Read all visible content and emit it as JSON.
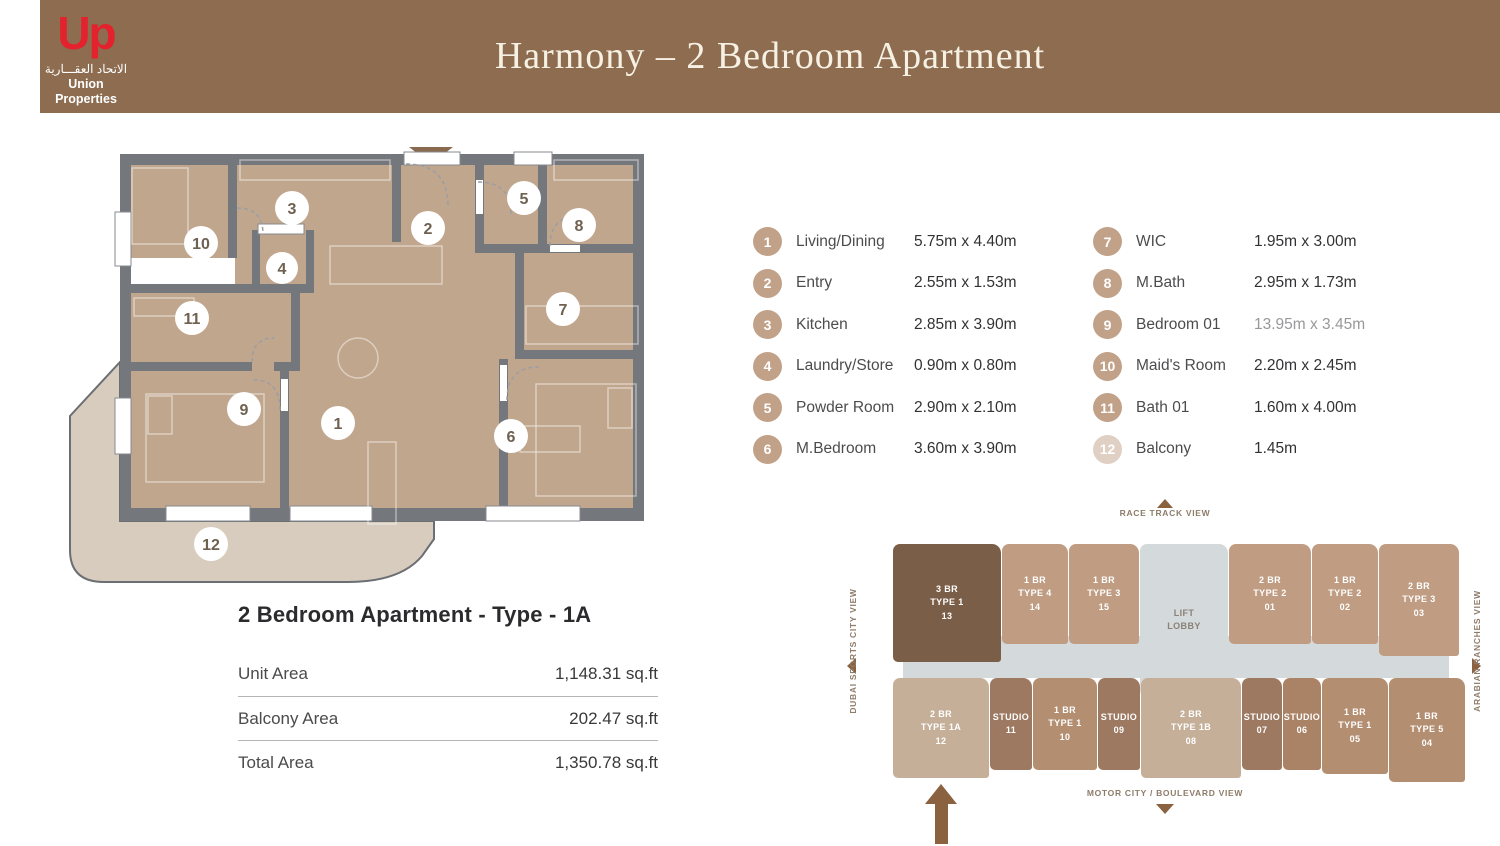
{
  "header": {
    "logo": {
      "mark": "Up",
      "arabic": "الاتحاد العقـــارية",
      "name": "Union Properties"
    },
    "title": "Harmony – 2 Bedroom Apartment"
  },
  "plan": {
    "markers": [
      "1",
      "2",
      "3",
      "4",
      "5",
      "6",
      "7",
      "8",
      "9",
      "10",
      "11",
      "12"
    ]
  },
  "legend": {
    "items": [
      {
        "num": "1",
        "label": "Living/Dining",
        "dims": "5.75m x 4.40m"
      },
      {
        "num": "2",
        "label": "Entry",
        "dims": "2.55m x 1.53m"
      },
      {
        "num": "3",
        "label": "Kitchen",
        "dims": "2.85m x 3.90m"
      },
      {
        "num": "4",
        "label": "Laundry/Store",
        "dims": "0.90m x 0.80m"
      },
      {
        "num": "5",
        "label": "Powder Room",
        "dims": "2.90m x 2.10m"
      },
      {
        "num": "6",
        "label": "M.Bedroom",
        "dims": "3.60m x 3.90m"
      },
      {
        "num": "7",
        "label": "WIC",
        "dims": "1.95m x 3.00m"
      },
      {
        "num": "8",
        "label": "M.Bath",
        "dims": "2.95m x 1.73m"
      },
      {
        "num": "9",
        "label": "Bedroom 01",
        "dims": "13.95m x 3.45m"
      },
      {
        "num": "10",
        "label": "Maid's Room",
        "dims": "2.20m x 2.45m"
      },
      {
        "num": "11",
        "label": "Bath 01",
        "dims": "1.60m x 4.00m"
      },
      {
        "num": "12",
        "label": "Balcony",
        "dims": "1.45m"
      }
    ]
  },
  "unit_info": {
    "title": "2 Bedroom Apartment - Type - 1A",
    "rows": [
      {
        "label": "Unit Area",
        "value": "1,148.31 sq.ft"
      },
      {
        "label": "Balcony Area",
        "value": "202.47 sq.ft"
      },
      {
        "label": "Total Area",
        "value": "1,350.78 sq.ft"
      }
    ]
  },
  "keyplan": {
    "views": {
      "top": "RACE TRACK VIEW",
      "bottom": "MOTOR CITY / BOULEVARD VIEW",
      "left": "DUBAI SPORTS CITY VIEW",
      "right": "ARABIAN RANCHES VIEW"
    },
    "top_row": [
      {
        "l1": "3 BR",
        "l2": "TYPE 1",
        "l3": "13"
      },
      {
        "l1": "1 BR",
        "l2": "TYPE 4",
        "l3": "14"
      },
      {
        "l1": "1 BR",
        "l2": "TYPE 3",
        "l3": "15"
      },
      {
        "l1": "LIFT",
        "l2": "LOBBY",
        "l3": ""
      },
      {
        "l1": "2 BR",
        "l2": "TYPE 2",
        "l3": "01"
      },
      {
        "l1": "1 BR",
        "l2": "TYPE 2",
        "l3": "02"
      },
      {
        "l1": "2 BR",
        "l2": "TYPE 3",
        "l3": "03"
      }
    ],
    "bottom_row": [
      {
        "l1": "2 BR",
        "l2": "TYPE 1A",
        "l3": "12"
      },
      {
        "l1": "STUDIO",
        "l2": "11",
        "l3": ""
      },
      {
        "l1": "1 BR",
        "l2": "TYPE 1",
        "l3": "10"
      },
      {
        "l1": "STUDIO",
        "l2": "09",
        "l3": ""
      },
      {
        "l1": "2 BR",
        "l2": "TYPE 1B",
        "l3": "08"
      },
      {
        "l1": "STUDIO",
        "l2": "07",
        "l3": ""
      },
      {
        "l1": "STUDIO",
        "l2": "06",
        "l3": ""
      },
      {
        "l1": "1 BR",
        "l2": "TYPE 1",
        "l3": "05"
      },
      {
        "l1": "1 BR",
        "l2": "TYPE 5",
        "l3": "04"
      }
    ]
  },
  "colors": {
    "header_bg": "#8D6C50",
    "logo_red": "#E3222D",
    "title_cream": "#F7F1E3",
    "wall": "#74777C",
    "floor": "#C1A68E",
    "balcony_floor": "#D7CCBD",
    "legend_circle": "#C2A189",
    "unit_dark": "#7B5E48",
    "unit_mid": "#BF9C82",
    "unit_mid2": "#B38E71",
    "unit_light": "#C6AF99",
    "studio": "#9C7960",
    "studio_alt": "#AA8266",
    "lobby": "#D4D9DB",
    "view_label": "#8D7C69",
    "arrow": "#8A6240"
  }
}
